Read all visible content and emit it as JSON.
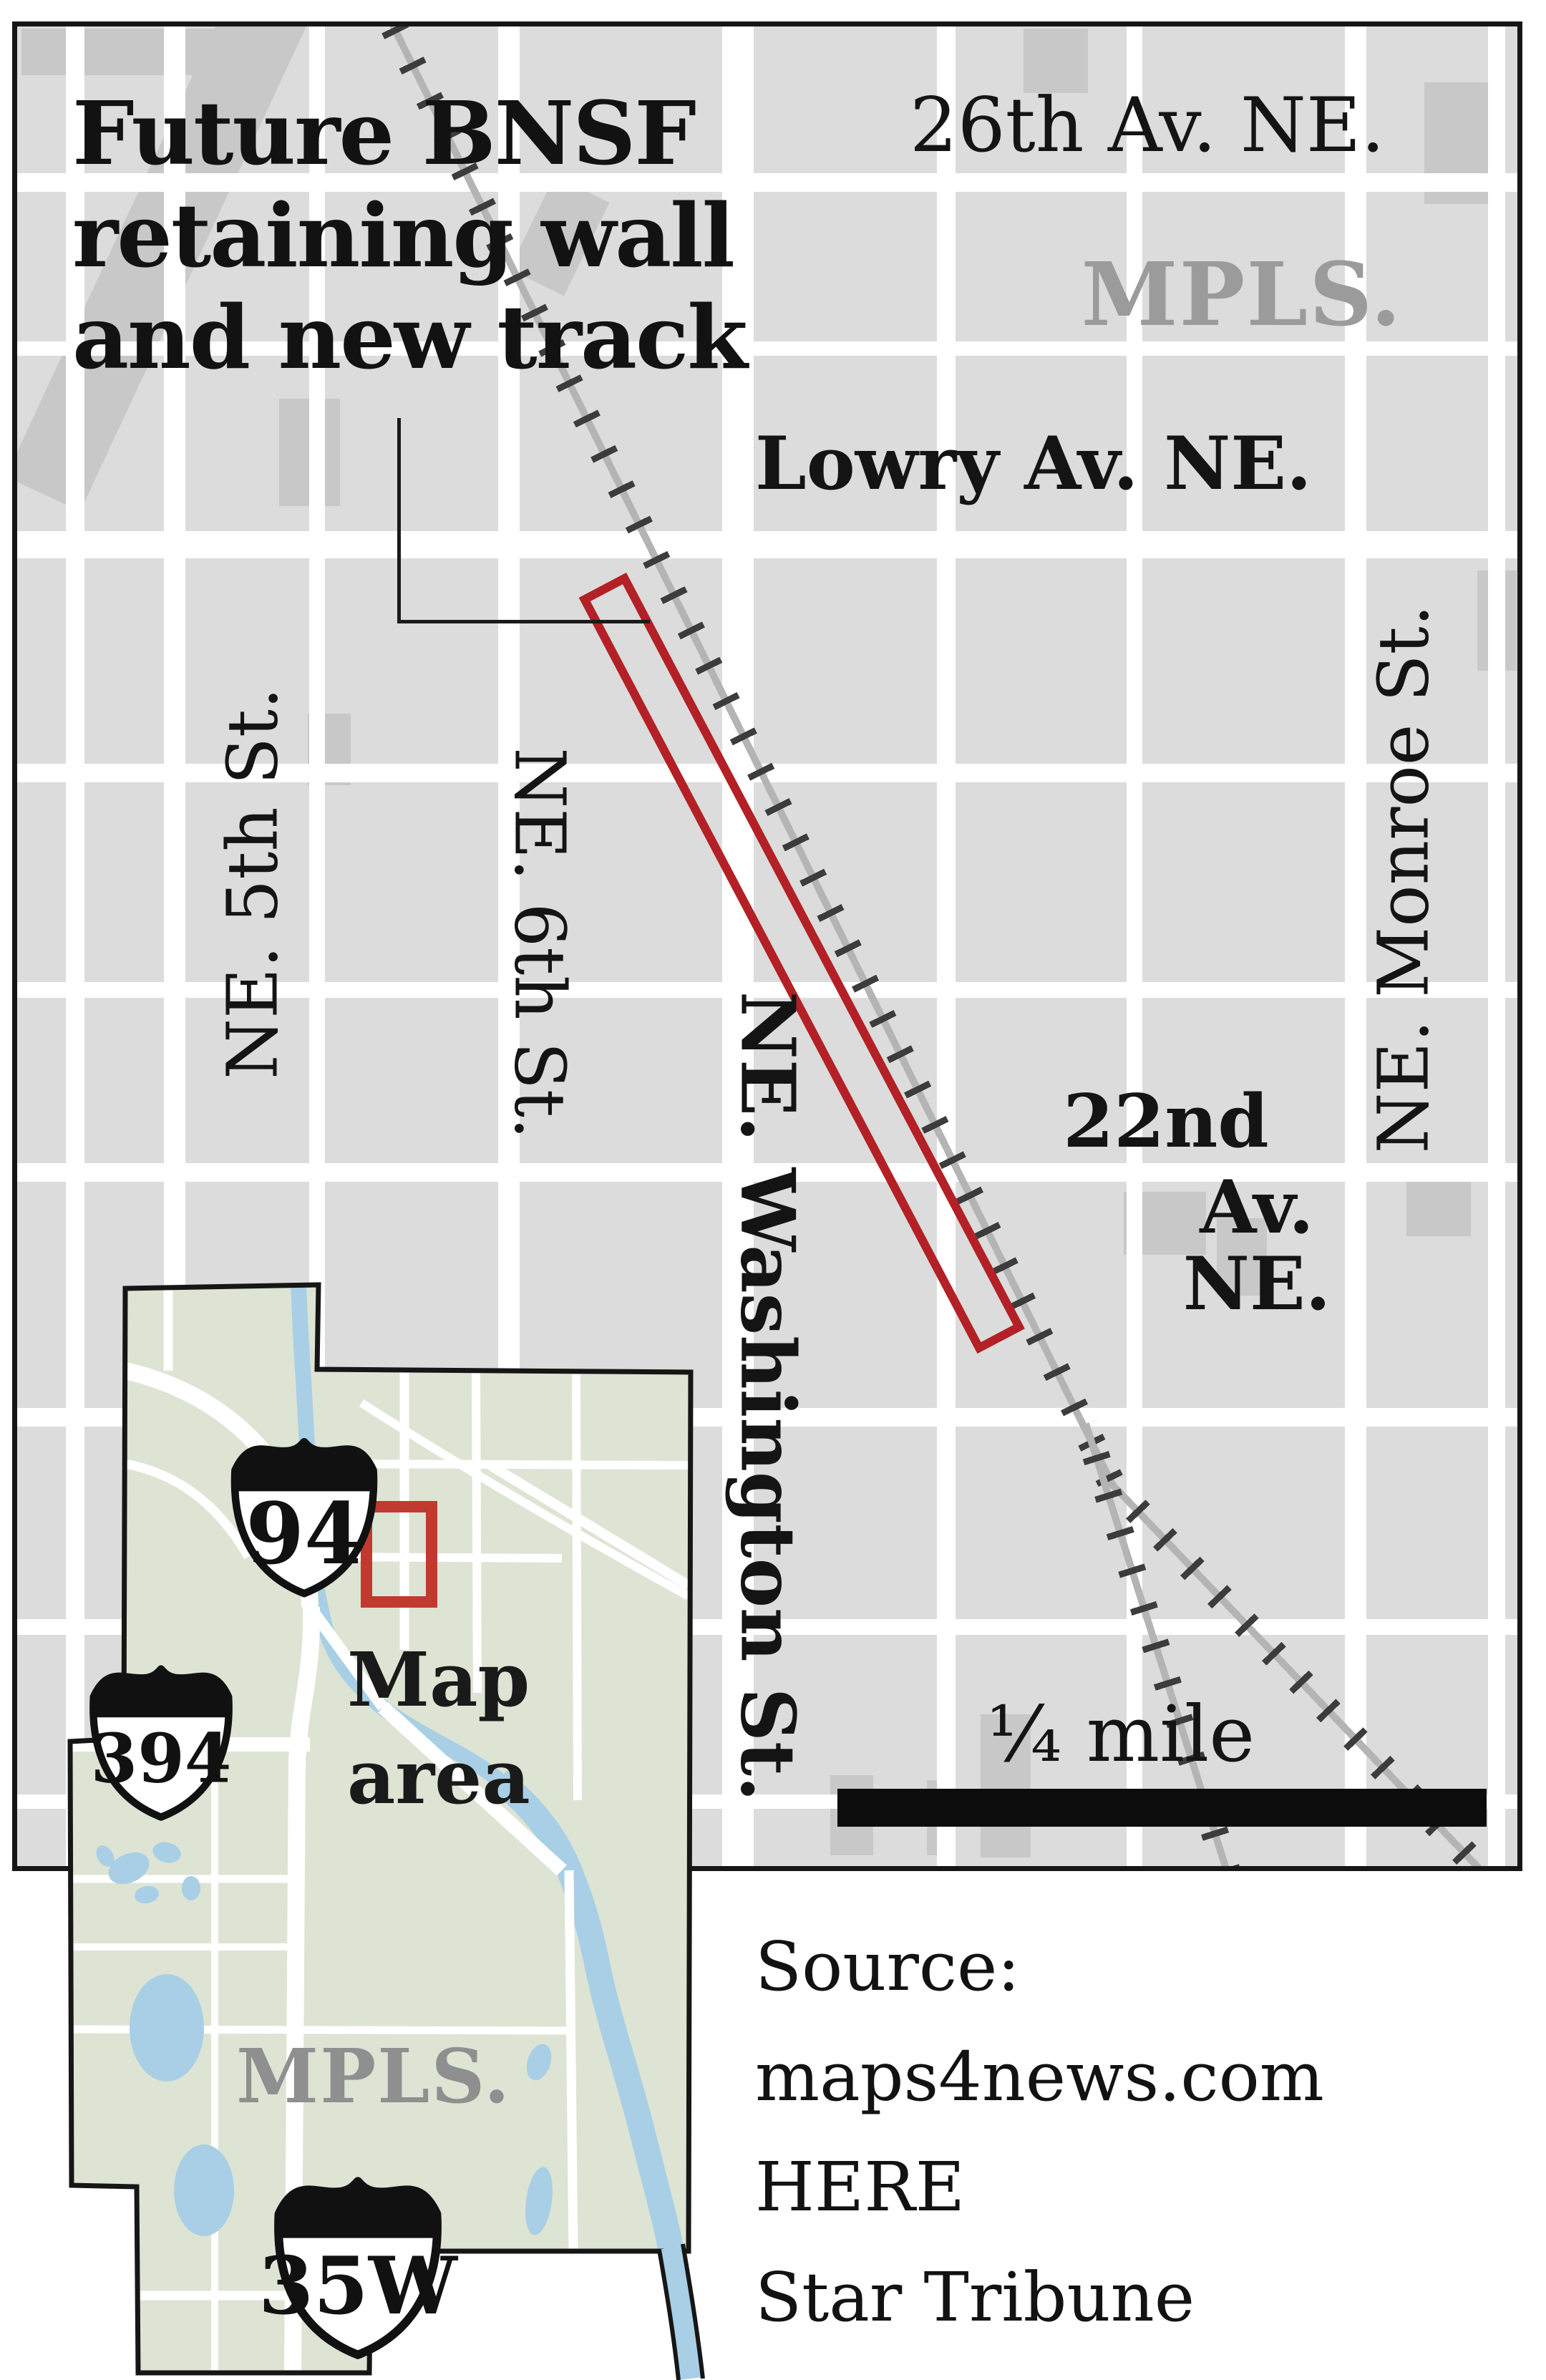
{
  "graphic": {
    "title_line1": "Future BNSF",
    "title_line2": "retaining wall",
    "title_line3": "and new track",
    "scale_label": "¼ mile",
    "source_line1": "Source:",
    "source_line2": "maps4news.com HERE",
    "source_line3": "Star Tribune"
  },
  "main_map": {
    "city_label": "MPLS.",
    "streets": {
      "av26": "26th Av. NE.",
      "lowry": "Lowry Av. NE.",
      "av22_line1": "22nd",
      "av22_line2": "Av. NE.",
      "st5": "NE. 5th St.",
      "st6": "NE. 6th St.",
      "washington": "NE. Washington St.",
      "monroe": "NE. Monroe St."
    }
  },
  "inset": {
    "city_label": "MPLS.",
    "map_area_line1": "Map",
    "map_area_line2": "area",
    "shield_94": "94",
    "shield_394": "394",
    "shield_35w": "35W"
  },
  "colors": {
    "block_gray": "#dcdcdc",
    "street_white": "#ffffff",
    "building_gray": "#c8c8c8",
    "rail_gray": "#b4b4b4",
    "rail_tie": "#3c3c3c",
    "wall_red": "#b32025",
    "marker_red": "#c03a30",
    "inset_land_green": "#dde4d4",
    "water_blue": "#a8cfe5",
    "muted_gray_label": "#9b9b9b",
    "ink": "#141414"
  }
}
